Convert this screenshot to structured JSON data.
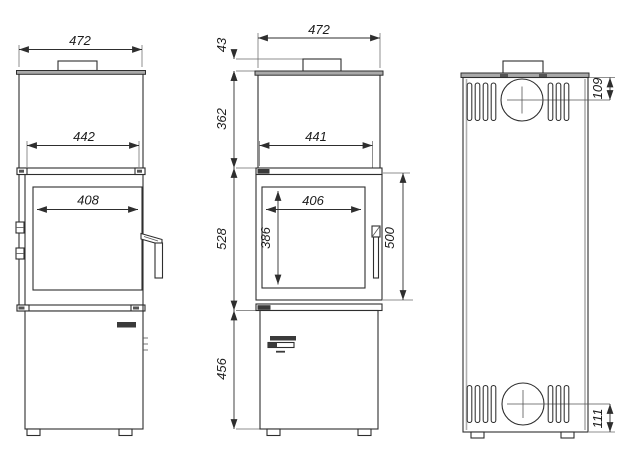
{
  "drawing": {
    "background": "#ffffff",
    "line_color": "#2e2e2e",
    "plate_fill": "#a9a9a9",
    "views": {
      "side": {
        "label": "side view",
        "dims": {
          "overall_width": "472",
          "body_inner_width": "442",
          "glass_width": "408"
        }
      },
      "front": {
        "label": "front view",
        "dims": {
          "overall_width": "472",
          "flue_collar_height": "43",
          "top_section_height": "362",
          "body_inner_width": "441",
          "firebox_section_height": "528",
          "glass_width": "406",
          "glass_height": "386",
          "door_height": "500",
          "base_section_height": "456"
        }
      },
      "back": {
        "label": "back view",
        "dims": {
          "flue_axis_from_top": "109",
          "inlet_axis_from_bottom": "111"
        }
      }
    }
  }
}
